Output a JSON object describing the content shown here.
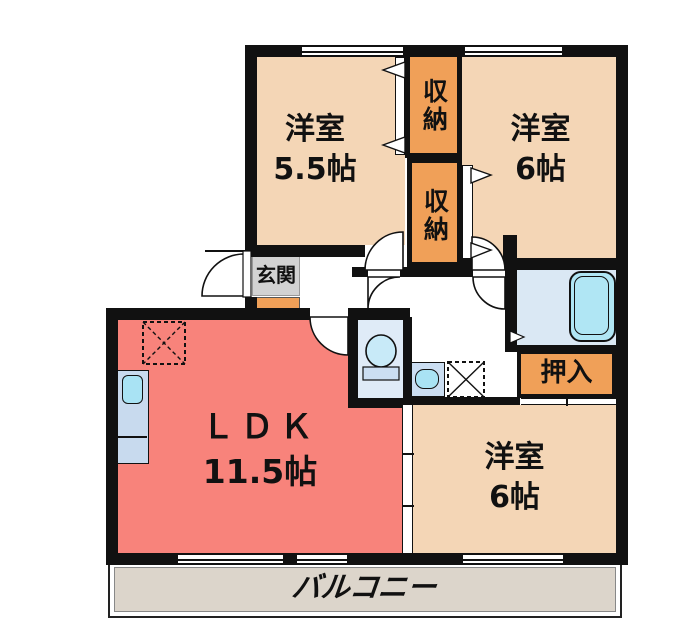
{
  "plan": {
    "bedroom_nw": {
      "label": "洋室",
      "size": "5.5帖"
    },
    "bedroom_ne": {
      "label": "洋室",
      "size": "6帖"
    },
    "bedroom_se": {
      "label": "洋室",
      "size": "6帖"
    },
    "ldk": {
      "label": "ＬＤＫ",
      "size": "11.5帖"
    },
    "closet_top": {
      "label": "収納"
    },
    "closet_bottom": {
      "label": "収納"
    },
    "oshiire": {
      "label": "押入"
    },
    "entrance": {
      "label": "玄関"
    },
    "balcony": {
      "label": "バルコニー"
    }
  },
  "colors": {
    "wall": "#111111",
    "peach": "#F4D6B6",
    "orange": "#F0A058",
    "salmon": "#F8837B",
    "balcony": "#DCD5CB",
    "gray": "#D2D2D2",
    "bathfloor": "#DAE8F4",
    "toiletfloor": "#DFEBF7",
    "tub": "#B0E6F4",
    "fixture": "#CBDEF2",
    "cyan": "#A9E3F4",
    "counter": "#C8DAEE"
  }
}
